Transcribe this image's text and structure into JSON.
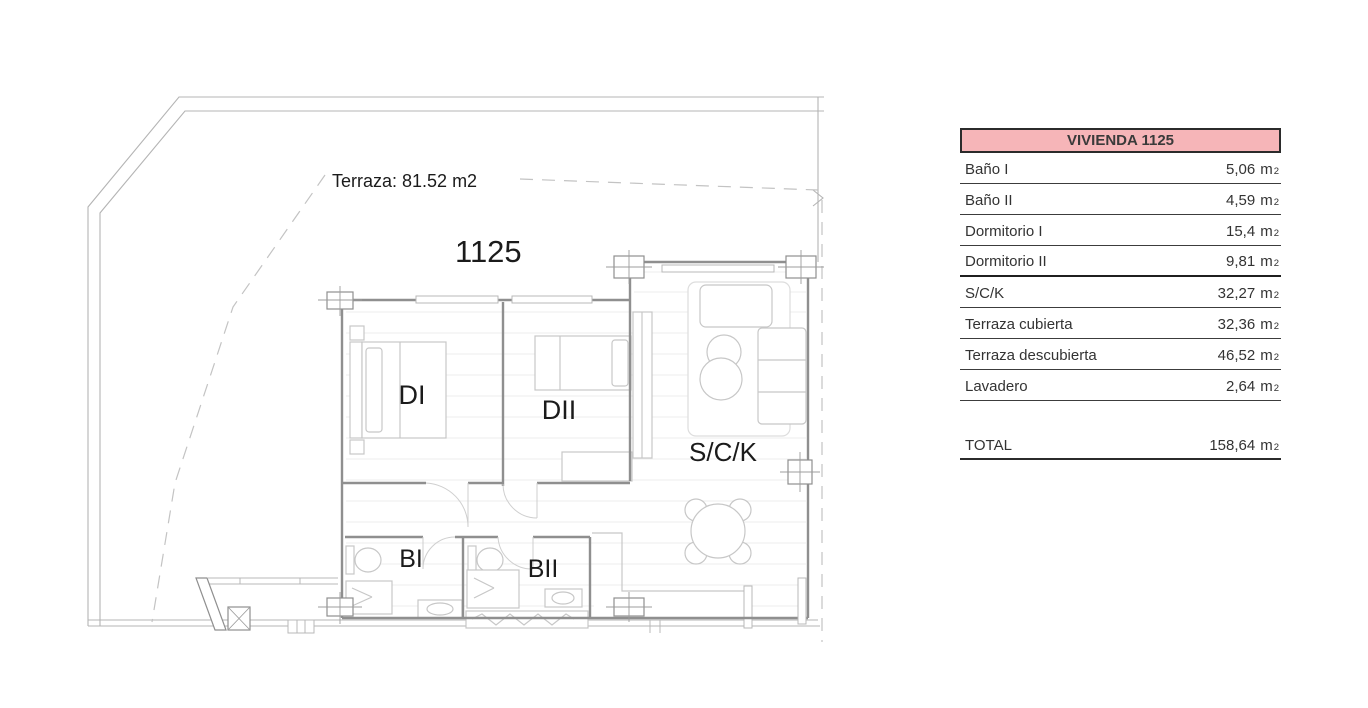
{
  "plan": {
    "terrace_label": "Terraza: 81.52 m2",
    "unit_number": "1125",
    "accent_red": "#bf3431",
    "labels": {
      "dormitorio_i": "DI",
      "dormitorio_ii": "DII",
      "salon_cocina": "S/C/K",
      "bano_i": "BI",
      "bano_ii": "BII"
    }
  },
  "table": {
    "title": "VIVIENDA 1125",
    "header_bg": "#f6b5b8",
    "rows": [
      {
        "label": "Baño I",
        "value": "5,06",
        "unit": "m",
        "sup": "2"
      },
      {
        "label": "Baño II",
        "value": "4,59",
        "unit": "m",
        "sup": "2"
      },
      {
        "label": "Dormitorio I",
        "value": "15,4",
        "unit": "m",
        "sup": "2"
      },
      {
        "label": "Dormitorio II",
        "value": "9,81",
        "unit": "m",
        "sup": "2"
      },
      {
        "label": "S/C/K",
        "value": "32,27",
        "unit": "m",
        "sup": "2"
      },
      {
        "label": "Terraza cubierta",
        "value": "32,36",
        "unit": "m",
        "sup": "2"
      },
      {
        "label": "Terraza descubierta",
        "value": "46,52",
        "unit": "m",
        "sup": "2"
      },
      {
        "label": "Lavadero",
        "value": "2,64",
        "unit": "m",
        "sup": "2"
      }
    ],
    "total": {
      "label": "TOTAL",
      "value": "158,64",
      "unit": "m",
      "sup": "2"
    }
  }
}
